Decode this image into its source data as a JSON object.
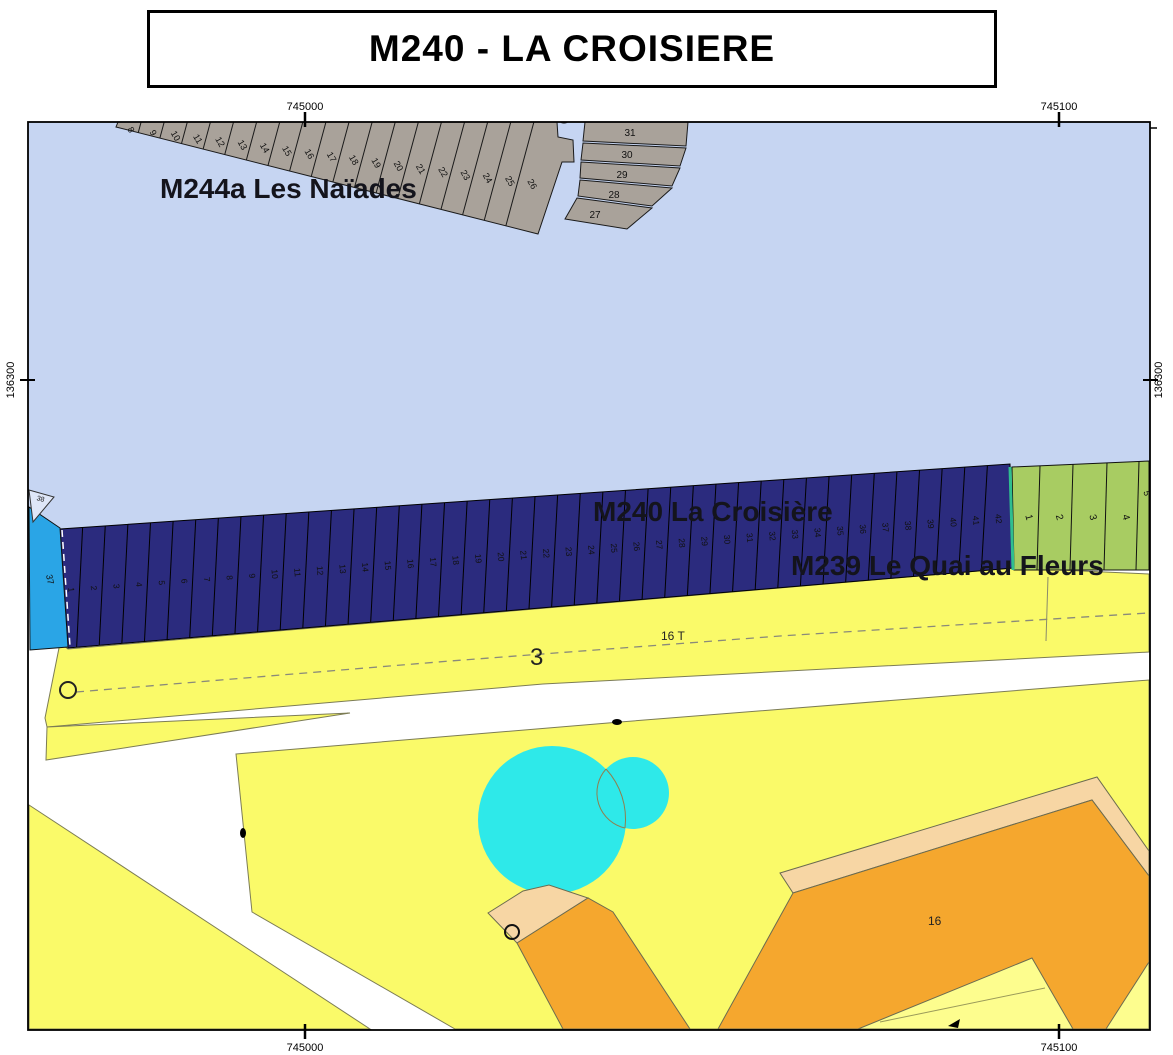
{
  "title": "M240 - LA CROISIERE",
  "axis": {
    "top": [
      "745000",
      "745100"
    ],
    "bottom": [
      "745000",
      "745100"
    ],
    "left": "136300",
    "right": "136300"
  },
  "labels": {
    "naiades": "M244a Les Naïades",
    "croisiere": "M240 La Croisière",
    "quai": "M239 Le Quai au Fleurs",
    "road_number": "3",
    "plot_16t": "16 T",
    "plot_16": "16"
  },
  "parcels": {
    "naiades_slanted": [
      "8",
      "9",
      "10",
      "11",
      "12",
      "13",
      "14",
      "15",
      "16",
      "17",
      "18",
      "19",
      "20",
      "21",
      "22",
      "23",
      "24",
      "25",
      "26"
    ],
    "naiades_stack": [
      "31",
      "30",
      "29",
      "28",
      "27"
    ],
    "croisiere": [
      "1",
      "2",
      "3",
      "4",
      "5",
      "6",
      "7",
      "8",
      "9",
      "10",
      "11",
      "12",
      "13",
      "14",
      "15",
      "16",
      "17",
      "18",
      "19",
      "20",
      "21",
      "22",
      "23",
      "24",
      "25",
      "26",
      "27",
      "28",
      "29",
      "30",
      "31",
      "32",
      "33",
      "34",
      "35",
      "36",
      "37",
      "38",
      "39",
      "40",
      "41",
      "42"
    ],
    "quai": [
      "1",
      "2",
      "3",
      "4",
      "5"
    ],
    "blue_parcel": "37",
    "blue_triangle": "38"
  },
  "colors": {
    "water": "#c6d5f2",
    "gray": "#a9a29a",
    "navy": "#2b2b7e",
    "blue": "#2aa5e6",
    "green": "#a8cc62",
    "teal": "#2fbe8f",
    "yellow": "#fafa69",
    "pale_yellow": "#fdfd8e",
    "orange": "#f5a72e",
    "tan": "#f7d6a4",
    "cyan": "#2ee9e9",
    "outline": "#7c7c55",
    "frame": "#000000"
  }
}
